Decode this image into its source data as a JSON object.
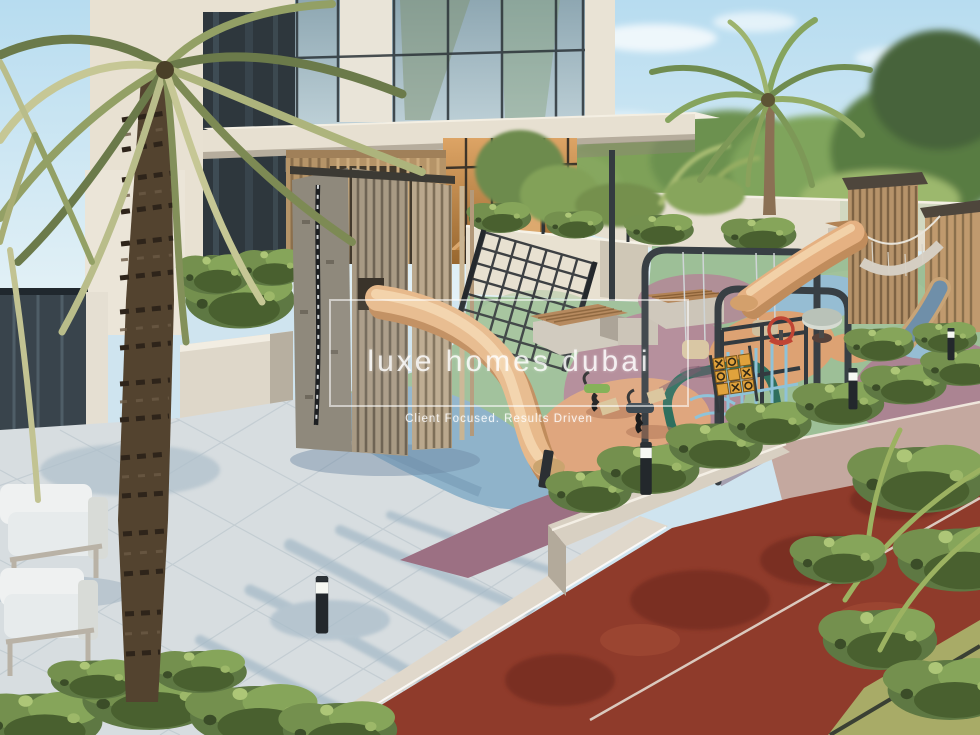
{
  "watermark": {
    "brand": "luxe homes dubai",
    "tagline": "Client Focused. Results Driven"
  },
  "scene": {
    "subject": "3D rendering of a residential courtyard children's playground with palm trees, slides, swings, benches and a red running track",
    "palette": {
      "sky": "#bfe0f0",
      "building_white": "#eae3d4",
      "glass": "#9fb6c0",
      "interior_warm": "#d79a5b",
      "timber": "#c2a176",
      "slide_tan": "#e7b98b",
      "rubber_green": "#9dbf97",
      "rubber_mauve": "#b28a97",
      "rubber_blue": "#8fb3ca",
      "rubber_salmon": "#dfa67e",
      "teal_loop": "#2f6f5e",
      "track_red": "#8f3b2b",
      "pavement": "#d7dde0",
      "foliage": "#6b7a4a",
      "steel": "#383f44"
    }
  }
}
